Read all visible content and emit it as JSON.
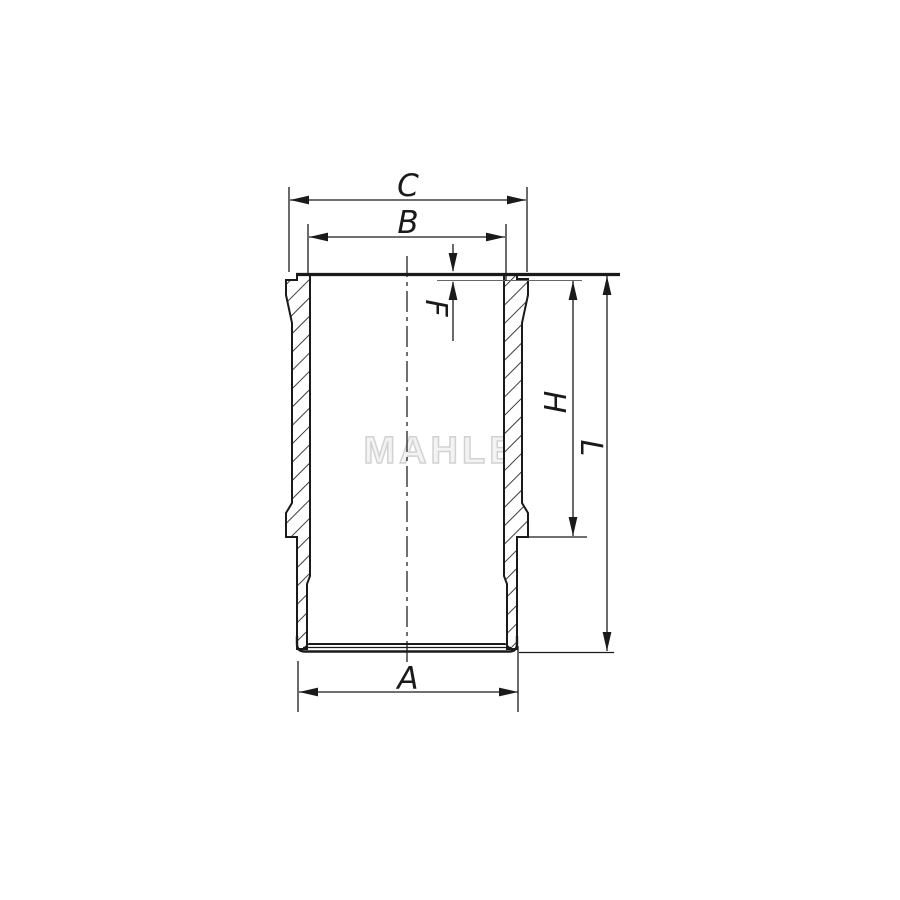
{
  "drawing": {
    "watermark": "MAHLE",
    "labels": {
      "c": "C",
      "b": "B",
      "f": "F",
      "h": "H",
      "l": "L",
      "a": "A"
    },
    "colors": {
      "object_line": "#1a1a1a",
      "dimension_line": "#1a1a1a",
      "lip_reference_line": "#666666",
      "watermark_stroke": "#d2d2d2",
      "watermark_fill": "#f3f3f3",
      "background": "#ffffff"
    }
  }
}
